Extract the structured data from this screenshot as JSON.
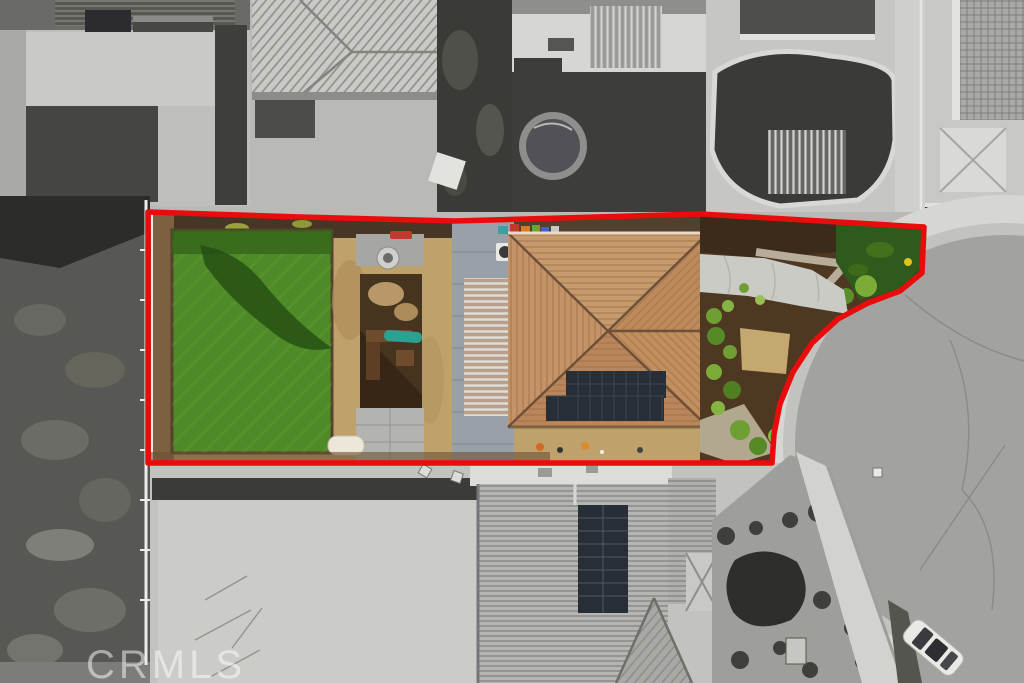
{
  "image": {
    "width": 1024,
    "height": 683,
    "kind": "aerial drone photograph of a residential lot"
  },
  "watermark": {
    "text": "CRMLS",
    "color": "#ffffff",
    "opacity": 0.5
  },
  "boundary": {
    "color": "#e80c0c",
    "stroke_width": 5.5,
    "style": "solid",
    "role": "red property-lot outline"
  },
  "colors": {
    "lawn": "#4f8a28",
    "lawn_shadow": "#234d12",
    "roof_tile": "#c79a6d",
    "roof_ridge": "#6e5038",
    "solar_panels": "#272e36",
    "slide": "#2aa191",
    "play_mulch": "#46341f",
    "dirt": "#bfa26b",
    "front_mulch": "#4f3822",
    "bush": "#6f9e33",
    "driveway": "#cbcbc5",
    "street": "#a2a2a0",
    "sidewalk": "#d6d6d2",
    "concrete": "#c2c2be",
    "red_toy": "#c23a2c"
  },
  "scene": {
    "effect": "subject parcel inside red outline shown in color; surrounding neighborhood desaturated to grayscale",
    "parcel_features": [
      "backyard lawn with tree shadow",
      "dirt yard",
      "playground with teal slide",
      "fire-pit patio",
      "white garden bench",
      "concrete side walkway",
      "striped patio cover",
      "terracotta tile hip roof",
      "rooftop solar array",
      "front landscaping bushes",
      "front grass patch",
      "curved concrete driveway"
    ],
    "surroundings": [
      "neighbor houses with tile roofs",
      "above-ground pool",
      "backyard pergolas",
      "cul-de-sac street",
      "curved sidewalk",
      "white parked car",
      "vacant weedy lot",
      "large concrete pad",
      "neighbor roof with solar panels",
      "desert gravel landscaping"
    ]
  }
}
